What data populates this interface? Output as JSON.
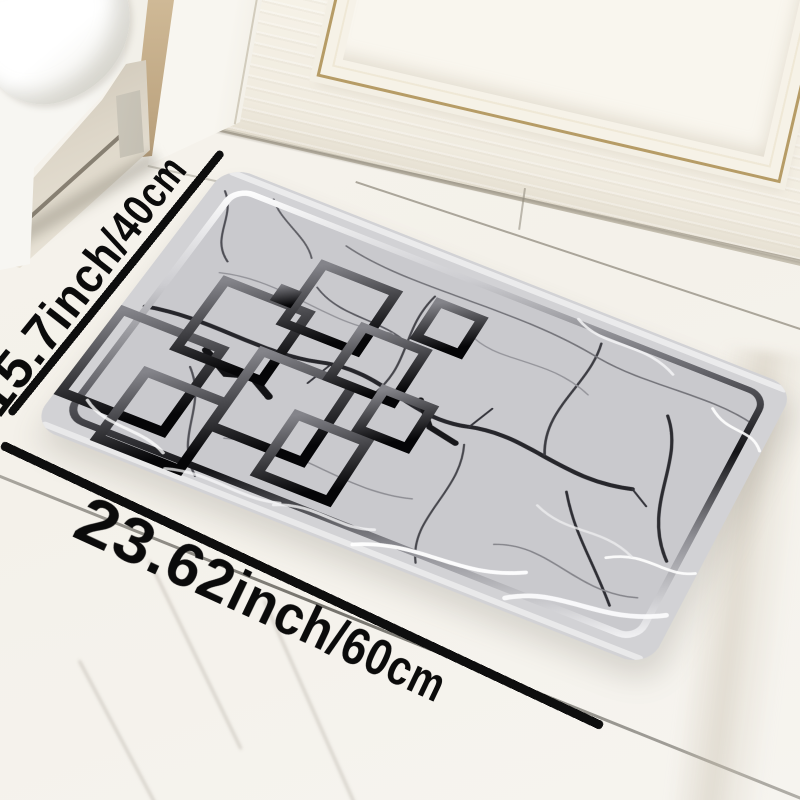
{
  "scene": {
    "type": "e-commerce product photo",
    "subject": "marble-pattern rectangular floor mat lying on a white marble floor in front of a white paneled door with gold trim, white cabinet at top left"
  },
  "dimension_annotations": {
    "side_label": "15.7inch/40cm",
    "bottom_label": "23.62inch/60cm"
  },
  "colors": {
    "dimension_line": "#0e0e0e",
    "mat_base": "#d0d0d4",
    "mat_margin_light": "#e2e2e5",
    "marble_crack_dark": "#232327",
    "ornament_gradient_start": "#77777d",
    "ornament_gradient_end": "#08080a",
    "inner_frame_silver": "#f2f2f4",
    "door_trim_gold": "#b69c66",
    "wall_accent_tan": "#bfa783",
    "floor_base": "#f4f1ea"
  }
}
